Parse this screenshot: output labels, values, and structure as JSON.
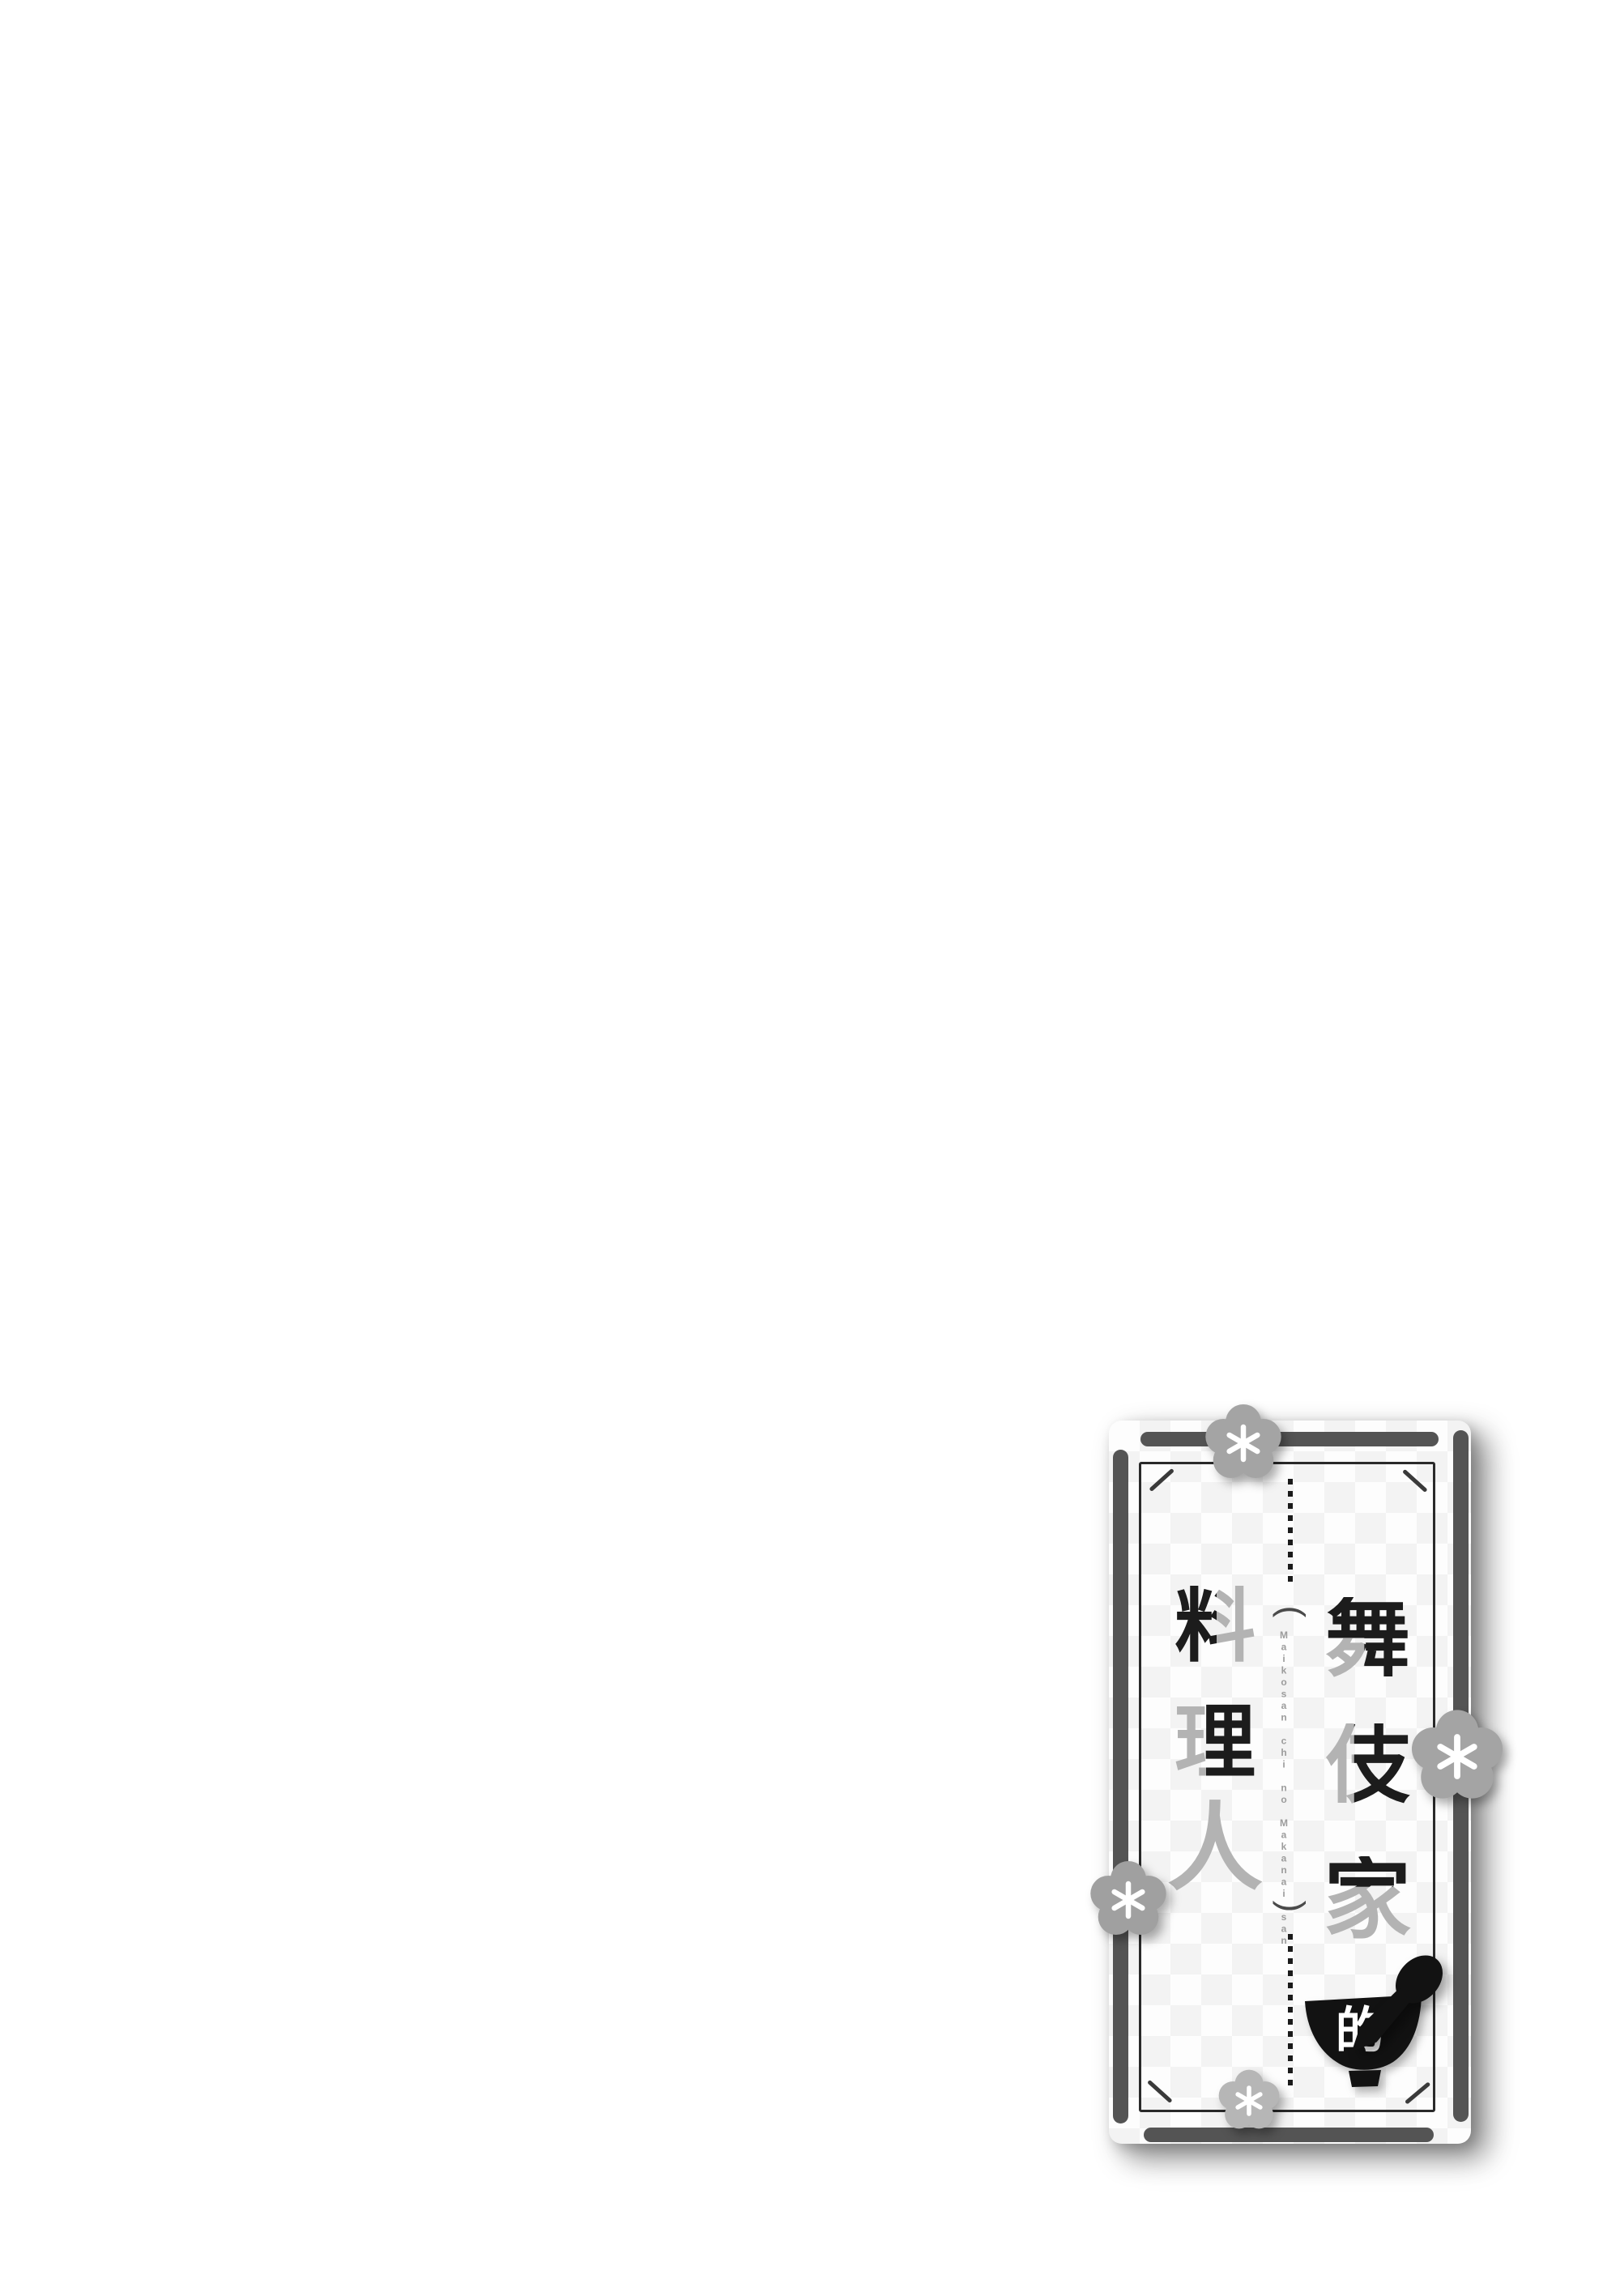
{
  "logo": {
    "kanji_right": [
      "舞",
      "伎",
      "家"
    ],
    "kanji_left": [
      "料",
      "理",
      "人"
    ],
    "possessive": "的",
    "romaji": "Maikosan chi no Makanai san",
    "paren_open": "(",
    "paren_close": ")"
  },
  "colors": {
    "frame_bar_gray": "#545454",
    "kanji_black": "#1c1c1c",
    "kanji_gray": "#b3b3b3",
    "romaji_gray": "#9c9c9c",
    "flower_gray": "#a4a4a4",
    "flower_light_gray": "#b6b6b6",
    "bowl_black": "#121212",
    "card_background": "#fdfdfd"
  },
  "icons": {
    "flower": "plum-blossom-icon",
    "bowl": "rice-bowl-icon",
    "spoon": "spoon-icon"
  }
}
